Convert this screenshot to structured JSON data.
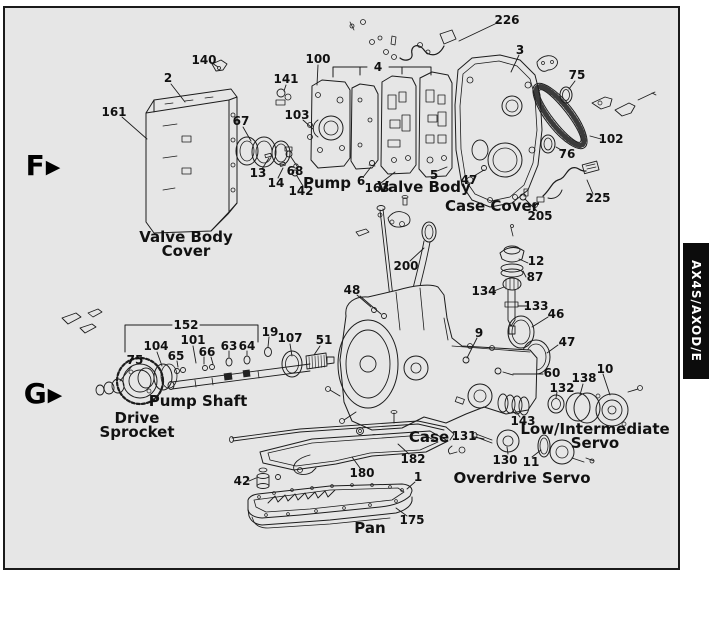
{
  "page": {
    "canvas_bg": "#ffffff",
    "frame_fill": "#e6e6e6",
    "frame_border": "#1a1a1a",
    "line_color": "#1c1c1c",
    "text_color": "#111111",
    "tab_bg": "#0c0c0c",
    "tab_fg": "#ffffff"
  },
  "side_tab": {
    "label": "AX4S/AXOD/E"
  },
  "marker_arrow": "▶",
  "markers": [
    {
      "label": "F",
      "x": 43,
      "y": 166
    },
    {
      "label": "G",
      "x": 43,
      "y": 394
    }
  ],
  "callouts": [
    {
      "t": "226",
      "x": 507,
      "y": 20
    },
    {
      "t": "140",
      "x": 204,
      "y": 60
    },
    {
      "t": "100",
      "x": 318,
      "y": 59
    },
    {
      "t": "2",
      "x": 168,
      "y": 78
    },
    {
      "t": "141",
      "x": 286,
      "y": 79
    },
    {
      "t": "4",
      "x": 378,
      "y": 67
    },
    {
      "t": "3",
      "x": 520,
      "y": 50
    },
    {
      "t": "75",
      "x": 577,
      "y": 75
    },
    {
      "t": "161",
      "x": 114,
      "y": 112
    },
    {
      "t": "103",
      "x": 297,
      "y": 115
    },
    {
      "t": "67",
      "x": 241,
      "y": 121
    },
    {
      "t": "102",
      "x": 611,
      "y": 139
    },
    {
      "t": "76",
      "x": 567,
      "y": 154
    },
    {
      "t": "13",
      "x": 258,
      "y": 173
    },
    {
      "t": "14",
      "x": 276,
      "y": 183
    },
    {
      "t": "68",
      "x": 295,
      "y": 171
    },
    {
      "t": "142",
      "x": 301,
      "y": 191
    },
    {
      "t": "6",
      "x": 361,
      "y": 181
    },
    {
      "t": "163",
      "x": 377,
      "y": 188
    },
    {
      "t": "5",
      "x": 434,
      "y": 175
    },
    {
      "t": "47",
      "x": 469,
      "y": 180
    },
    {
      "t": "225",
      "x": 598,
      "y": 198
    },
    {
      "t": "205",
      "x": 540,
      "y": 216
    },
    {
      "t": "200",
      "x": 406,
      "y": 266
    },
    {
      "t": "48",
      "x": 352,
      "y": 290
    },
    {
      "t": "12",
      "x": 536,
      "y": 261
    },
    {
      "t": "87",
      "x": 535,
      "y": 277
    },
    {
      "t": "134",
      "x": 484,
      "y": 291
    },
    {
      "t": "133",
      "x": 536,
      "y": 306
    },
    {
      "t": "46",
      "x": 556,
      "y": 314
    },
    {
      "t": "9",
      "x": 479,
      "y": 333
    },
    {
      "t": "47",
      "x": 567,
      "y": 342
    },
    {
      "t": "60",
      "x": 552,
      "y": 373
    },
    {
      "t": "138",
      "x": 584,
      "y": 378
    },
    {
      "t": "10",
      "x": 605,
      "y": 369
    },
    {
      "t": "132",
      "x": 562,
      "y": 388
    },
    {
      "t": "152",
      "x": 186,
      "y": 325
    },
    {
      "t": "19",
      "x": 270,
      "y": 332
    },
    {
      "t": "107",
      "x": 290,
      "y": 338
    },
    {
      "t": "51",
      "x": 324,
      "y": 340
    },
    {
      "t": "104",
      "x": 156,
      "y": 346
    },
    {
      "t": "101",
      "x": 193,
      "y": 340
    },
    {
      "t": "65",
      "x": 176,
      "y": 356
    },
    {
      "t": "66",
      "x": 207,
      "y": 352
    },
    {
      "t": "63",
      "x": 229,
      "y": 346
    },
    {
      "t": "64",
      "x": 247,
      "y": 346
    },
    {
      "t": "75",
      "x": 135,
      "y": 360
    },
    {
      "t": "143",
      "x": 523,
      "y": 421
    },
    {
      "t": "131",
      "x": 464,
      "y": 436
    },
    {
      "t": "130",
      "x": 505,
      "y": 460
    },
    {
      "t": "11",
      "x": 531,
      "y": 462
    },
    {
      "t": "182",
      "x": 413,
      "y": 459
    },
    {
      "t": "42",
      "x": 242,
      "y": 481
    },
    {
      "t": "180",
      "x": 362,
      "y": 473
    },
    {
      "t": "1",
      "x": 418,
      "y": 477
    },
    {
      "t": "175",
      "x": 412,
      "y": 520
    }
  ],
  "part_names": [
    {
      "t": "Pump",
      "x": 327,
      "y": 183
    },
    {
      "t": "Valve Body",
      "x": 424,
      "y": 187
    },
    {
      "t": "Case Cover",
      "x": 492,
      "y": 206
    },
    {
      "t": "Valve Body\nCover",
      "x": 186,
      "y": 244
    },
    {
      "t": "Pump Shaft",
      "x": 198,
      "y": 401
    },
    {
      "t": "Drive\nSprocket",
      "x": 137,
      "y": 425
    },
    {
      "t": "Case",
      "x": 429,
      "y": 437
    },
    {
      "t": "Low/Intermediate\nServo",
      "x": 595,
      "y": 436
    },
    {
      "t": "Overdrive Servo",
      "x": 522,
      "y": 478
    },
    {
      "t": "Pan",
      "x": 370,
      "y": 528
    }
  ]
}
